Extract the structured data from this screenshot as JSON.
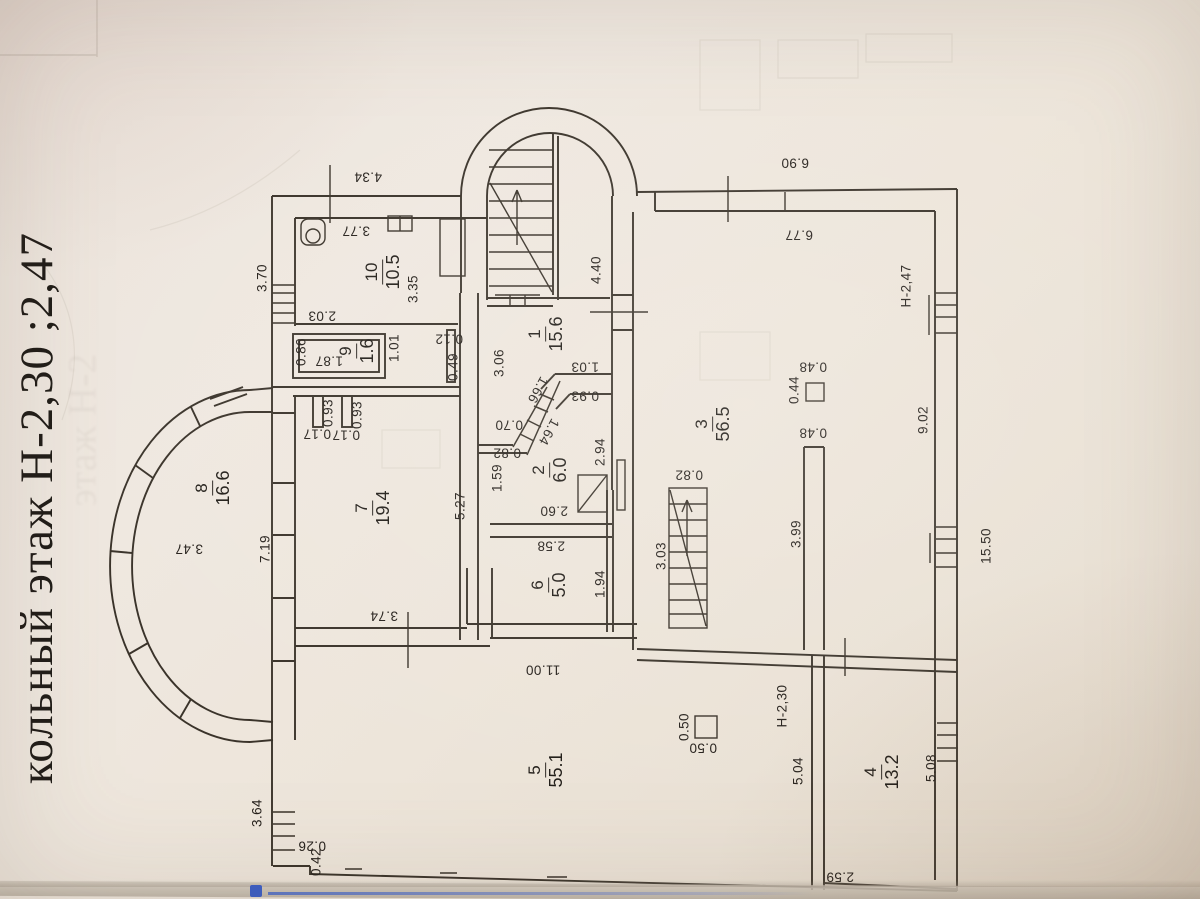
{
  "title": {
    "floor_label": "кольный этаж  Н-2,30 ;2,47",
    "ghost_label": "этаж Н-2"
  },
  "colors": {
    "paper": "#ece4dc",
    "ink": "#3a332a",
    "label_ink": "#26211c",
    "accent_blue": "#3b5ec6"
  },
  "icons": {
    "stair_direction": "up-arrow"
  },
  "rooms": [
    {
      "number": "10",
      "area": "10.5",
      "x": 383,
      "y": 272
    },
    {
      "number": "9",
      "area": "1.6",
      "x": 357,
      "y": 351
    },
    {
      "number": "1",
      "area": "15.6",
      "x": 546,
      "y": 334
    },
    {
      "number": "2",
      "area": "6.0",
      "x": 550,
      "y": 470
    },
    {
      "number": "3",
      "area": "56.5",
      "x": 713,
      "y": 424
    },
    {
      "number": "7",
      "area": "19.4",
      "x": 373,
      "y": 508
    },
    {
      "number": "8",
      "area": "16.6",
      "x": 213,
      "y": 488
    },
    {
      "number": "6",
      "area": "5.0",
      "x": 549,
      "y": 585
    },
    {
      "number": "5",
      "area": "55.1",
      "x": 546,
      "y": 770
    },
    {
      "number": "4",
      "area": "13.2",
      "x": 882,
      "y": 772
    }
  ],
  "dimensions": [
    {
      "text": "4.34",
      "x": 368,
      "y": 177,
      "rot": 180
    },
    {
      "text": "3.77",
      "x": 356,
      "y": 231,
      "rot": 180
    },
    {
      "text": "3.70",
      "x": 262,
      "y": 278,
      "rot": -90
    },
    {
      "text": "3.35",
      "x": 413,
      "y": 289,
      "rot": -90
    },
    {
      "text": "2.03",
      "x": 322,
      "y": 316,
      "rot": 180
    },
    {
      "text": "0.86",
      "x": 301,
      "y": 352,
      "rot": -90
    },
    {
      "text": "1.87",
      "x": 329,
      "y": 361,
      "rot": 180
    },
    {
      "text": "1.01",
      "x": 394,
      "y": 348,
      "rot": -90
    },
    {
      "text": "0.12",
      "x": 449,
      "y": 339,
      "rot": 180
    },
    {
      "text": "0.49",
      "x": 453,
      "y": 367,
      "rot": -90
    },
    {
      "text": "3.06",
      "x": 499,
      "y": 363,
      "rot": -90
    },
    {
      "text": "4.40",
      "x": 596,
      "y": 270,
      "rot": -90
    },
    {
      "text": "6.90",
      "x": 795,
      "y": 163,
      "rot": 180
    },
    {
      "text": "6.77",
      "x": 799,
      "y": 235,
      "rot": 180
    },
    {
      "text": "Н-2,47",
      "x": 906,
      "y": 286,
      "rot": -90
    },
    {
      "text": "1.03",
      "x": 585,
      "y": 367,
      "rot": 180
    },
    {
      "text": "0.93",
      "x": 585,
      "y": 396,
      "rot": 180
    },
    {
      "text": "1.66",
      "x": 538,
      "y": 390,
      "rot": 119
    },
    {
      "text": "1.64",
      "x": 549,
      "y": 432,
      "rot": 119
    },
    {
      "text": "0.70",
      "x": 509,
      "y": 425,
      "rot": 180
    },
    {
      "text": "0.82",
      "x": 507,
      "y": 453,
      "rot": 180
    },
    {
      "text": "1.59",
      "x": 497,
      "y": 478,
      "rot": -90
    },
    {
      "text": "2.94",
      "x": 600,
      "y": 452,
      "rot": -90
    },
    {
      "text": "0.93",
      "x": 328,
      "y": 413,
      "rot": -90
    },
    {
      "text": "0.93",
      "x": 357,
      "y": 415,
      "rot": -90
    },
    {
      "text": "0.17",
      "x": 317,
      "y": 434,
      "rot": 180
    },
    {
      "text": "0.17",
      "x": 346,
      "y": 435,
      "rot": 180
    },
    {
      "text": "0.44",
      "x": 794,
      "y": 390,
      "rot": -90
    },
    {
      "text": "0.48",
      "x": 813,
      "y": 367,
      "rot": 180
    },
    {
      "text": "0.48",
      "x": 813,
      "y": 433,
      "rot": 180
    },
    {
      "text": "9.02",
      "x": 923,
      "y": 420,
      "rot": -90
    },
    {
      "text": "0.82",
      "x": 689,
      "y": 475,
      "rot": 180
    },
    {
      "text": "3.03",
      "x": 661,
      "y": 556,
      "rot": -90
    },
    {
      "text": "3.99",
      "x": 796,
      "y": 534,
      "rot": -90
    },
    {
      "text": "15.50",
      "x": 986,
      "y": 546,
      "rot": -90
    },
    {
      "text": "3.47",
      "x": 189,
      "y": 549,
      "rot": 180
    },
    {
      "text": "7.19",
      "x": 265,
      "y": 549,
      "rot": -90
    },
    {
      "text": "5.27",
      "x": 460,
      "y": 506,
      "rot": -90
    },
    {
      "text": "2.60",
      "x": 554,
      "y": 511,
      "rot": 180
    },
    {
      "text": "2.58",
      "x": 551,
      "y": 546,
      "rot": 180
    },
    {
      "text": "1.94",
      "x": 600,
      "y": 584,
      "rot": -90
    },
    {
      "text": "3.74",
      "x": 384,
      "y": 616,
      "rot": 180
    },
    {
      "text": "11.00",
      "x": 543,
      "y": 670,
      "rot": 180
    },
    {
      "text": "0.50",
      "x": 684,
      "y": 727,
      "rot": -90
    },
    {
      "text": "0.50",
      "x": 703,
      "y": 748,
      "rot": 180
    },
    {
      "text": "Н-2,30",
      "x": 782,
      "y": 706,
      "rot": -90
    },
    {
      "text": "5.04",
      "x": 798,
      "y": 771,
      "rot": -90
    },
    {
      "text": "5.08",
      "x": 931,
      "y": 768,
      "rot": -90
    },
    {
      "text": "2.59",
      "x": 840,
      "y": 877,
      "rot": 180
    },
    {
      "text": "3.64",
      "x": 257,
      "y": 813,
      "rot": -90
    },
    {
      "text": "0.26",
      "x": 312,
      "y": 846,
      "rot": 180
    },
    {
      "text": "0.42",
      "x": 316,
      "y": 862,
      "rot": -90
    }
  ]
}
